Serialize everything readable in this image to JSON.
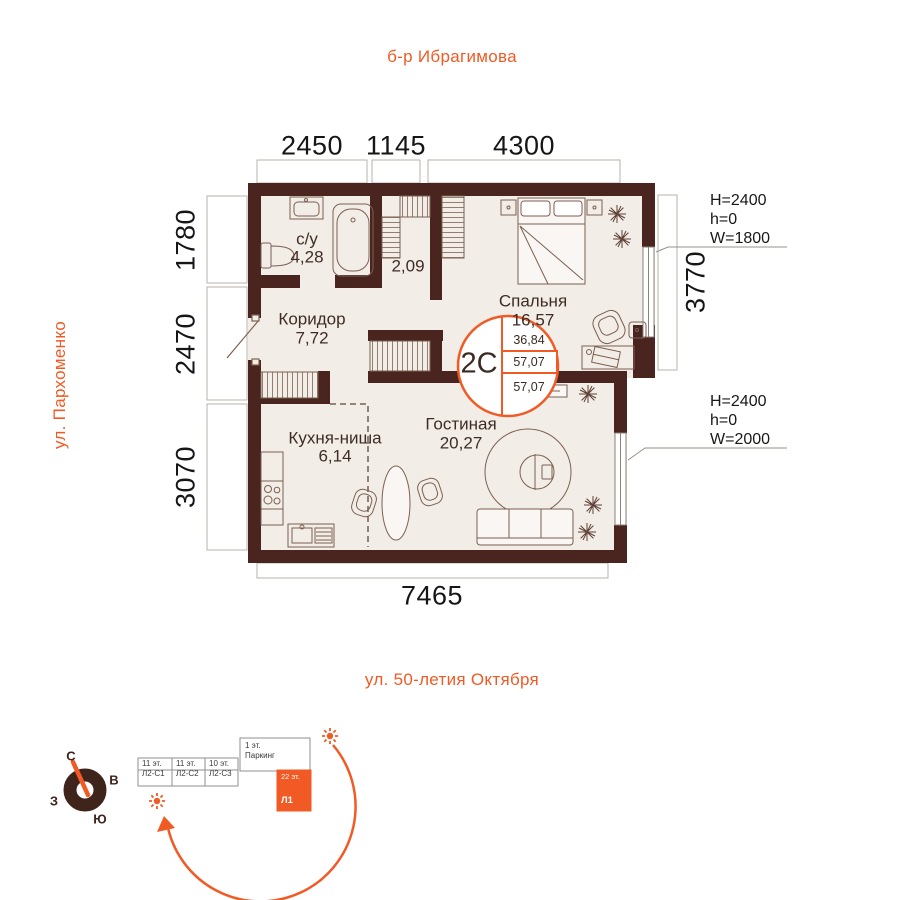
{
  "streets": {
    "top": "б-р Ибрагимова",
    "left": "ул. Пархоменко",
    "bottom": "ул. 50-летия Октября"
  },
  "dims": {
    "top": [
      "2450",
      "1145",
      "4300"
    ],
    "left": [
      "1780",
      "2470",
      "3070"
    ],
    "right": "3770",
    "bottom": "7465"
  },
  "windows": {
    "bedroom": {
      "height": "H=2400",
      "sill": "h=0",
      "width": "W=1800"
    },
    "living": {
      "height": "H=2400",
      "sill": "h=0",
      "width": "W=2000"
    }
  },
  "rooms": {
    "bath": {
      "name": "с/у",
      "area": "4,28"
    },
    "closet": {
      "area": "2,09"
    },
    "bedroom": {
      "name": "Спальня",
      "area": "16,57"
    },
    "hall": {
      "name": "Коридор",
      "area": "7,72"
    },
    "kitchen": {
      "name": "Кухня-ниша",
      "area": "6,14"
    },
    "living": {
      "name": "Гостиная",
      "area": "20,27"
    }
  },
  "badge": {
    "type": "2С",
    "rows": [
      "36,84",
      "57,07",
      "57,07"
    ]
  },
  "compass": {
    "north": "С",
    "east": "В",
    "west": "З",
    "south": "Ю"
  },
  "site": {
    "blocks": [
      {
        "floors": "11 эт.",
        "name": "Л2-С1"
      },
      {
        "floors": "11 эт.",
        "name": "Л2-С2"
      },
      {
        "floors": "10 эт.",
        "name": "Л2-С3"
      },
      {
        "floors": "1 эт.",
        "name": "Паркинг"
      }
    ],
    "tower": {
      "floors": "22 эт.",
      "name": "Л1"
    }
  },
  "colors": {
    "wall": "#4a241e",
    "accent": "#f15a24",
    "floor": "#f2ede7"
  }
}
